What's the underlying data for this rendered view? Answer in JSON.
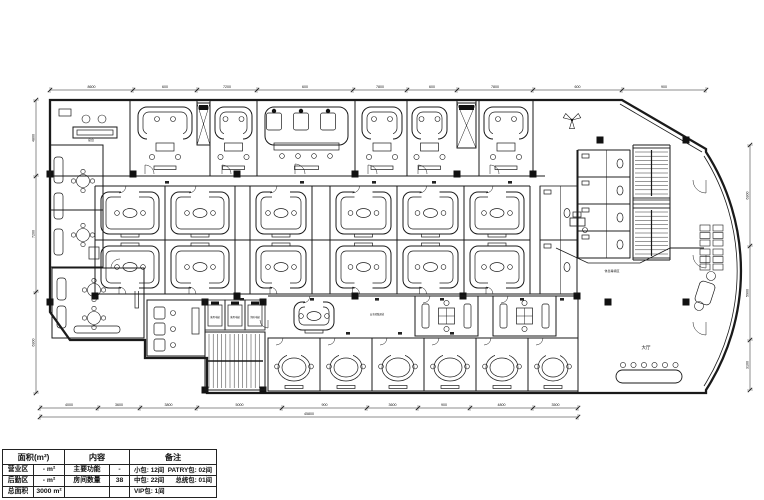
{
  "table": {
    "h1": "面积(m²)",
    "h2": "内容",
    "h3": "备注",
    "rows": [
      {
        "area_label": "营业区",
        "area_value": "- m²",
        "content_label": "主要功能",
        "content_value": "-",
        "remark_left": "小包: 12间",
        "remark_right": "PATRY包: 02间"
      },
      {
        "area_label": "后勤区",
        "area_value": "- m²",
        "content_label": "房间数量",
        "content_value": "38",
        "remark_left": "中包: 22间",
        "remark_right": "总统包: 01间"
      },
      {
        "area_label": "总面积",
        "area_value": "3000 m²",
        "content_label": "",
        "content_value": "",
        "remark_left": "VIP包: 1间",
        "remark_right": ""
      }
    ]
  },
  "plan": {
    "ink": "#1a1a1a",
    "outline": "M50,100 L622,100 L706,149 L706,152 A220 220 0 0 1 706,390 L706,393 L207,393 L207,358 L145,358 L145,340 L70,340 L50,312 Z",
    "extras": [
      "M704,156 A216 216 0 0 1 704,386",
      "M620,104 L702,152",
      "M556,248 L588,263 L640,263 L670,248",
      "M633,200 L670,200 M633,204 L670,204"
    ],
    "walls": [
      [
        50,
        176,
        545,
        176
      ],
      [
        95,
        186,
        530,
        186
      ],
      [
        95,
        240,
        530,
        240
      ],
      [
        95,
        294,
        577,
        294
      ],
      [
        130,
        100,
        130,
        176
      ],
      [
        197,
        100,
        197,
        145
      ],
      [
        210,
        100,
        210,
        176
      ],
      [
        257,
        100,
        257,
        176
      ],
      [
        355,
        100,
        355,
        176
      ],
      [
        407,
        100,
        407,
        176
      ],
      [
        457,
        100,
        457,
        148
      ],
      [
        476,
        100,
        476,
        148
      ],
      [
        479,
        100,
        479,
        176
      ],
      [
        533,
        100,
        533,
        176
      ],
      [
        95,
        186,
        95,
        294
      ],
      [
        165,
        186,
        165,
        294
      ],
      [
        235,
        186,
        235,
        294
      ],
      [
        250,
        186,
        250,
        294
      ],
      [
        312,
        186,
        312,
        294
      ],
      [
        330,
        186,
        330,
        294
      ],
      [
        397,
        186,
        397,
        294
      ],
      [
        464,
        186,
        464,
        294
      ],
      [
        530,
        186,
        530,
        294
      ],
      [
        540,
        186,
        540,
        294
      ],
      [
        577,
        150,
        577,
        294
      ],
      [
        578,
        150,
        630,
        150
      ],
      [
        578,
        258,
        630,
        258
      ],
      [
        630,
        150,
        630,
        258
      ],
      [
        578,
        150,
        578,
        258
      ],
      [
        633,
        145,
        633,
        260
      ],
      [
        670,
        145,
        670,
        260
      ],
      [
        633,
        145,
        670,
        145
      ],
      [
        633,
        260,
        670,
        260
      ],
      [
        670,
        248,
        704,
        248
      ],
      [
        578,
        296,
        578,
        393
      ],
      [
        50,
        145,
        103,
        145
      ],
      [
        103,
        145,
        103,
        267
      ],
      [
        50,
        267,
        103,
        267
      ],
      [
        50,
        210,
        103,
        210
      ],
      [
        268,
        296,
        578,
        296
      ]
    ],
    "columns": [
      [
        133,
        174
      ],
      [
        237,
        174
      ],
      [
        355,
        174
      ],
      [
        457,
        174
      ],
      [
        533,
        174
      ],
      [
        600,
        140
      ],
      [
        686,
        140
      ],
      [
        608,
        302
      ],
      [
        686,
        302
      ],
      [
        95,
        296
      ],
      [
        237,
        296
      ],
      [
        355,
        296
      ],
      [
        463,
        296
      ],
      [
        577,
        296
      ],
      [
        50,
        302
      ],
      [
        50,
        174
      ],
      [
        205,
        302
      ],
      [
        263,
        302
      ],
      [
        205,
        390
      ],
      [
        263,
        390
      ]
    ],
    "rooms": [
      {
        "k": "office",
        "x": 53,
        "y": 103,
        "w": 77,
        "h": 66
      },
      {
        "k": "uroom",
        "x": 133,
        "y": 103,
        "w": 64,
        "h": 70
      },
      {
        "k": "shaft",
        "x": 197,
        "y": 103,
        "w": 13,
        "h": 42
      },
      {
        "k": "uroom",
        "x": 210,
        "y": 103,
        "w": 47,
        "h": 70
      },
      {
        "k": "party",
        "x": 260,
        "y": 103,
        "w": 93,
        "h": 70
      },
      {
        "k": "uroom",
        "x": 357,
        "y": 103,
        "w": 50,
        "h": 70
      },
      {
        "k": "uroom",
        "x": 407,
        "y": 103,
        "w": 45,
        "h": 70
      },
      {
        "k": "shaft",
        "x": 457,
        "y": 103,
        "w": 19,
        "h": 45
      },
      {
        "k": "uroom",
        "x": 479,
        "y": 103,
        "w": 54,
        "h": 70
      },
      {
        "k": "loungeV",
        "x": 50,
        "y": 145,
        "w": 53,
        "h": 122
      },
      {
        "k": "loungeH",
        "x": 52,
        "y": 268,
        "w": 92,
        "h": 70
      },
      {
        "k": "midroom",
        "x": 95,
        "y": 186,
        "w": 70,
        "h": 54,
        "d": "u"
      },
      {
        "k": "midroom",
        "x": 165,
        "y": 186,
        "w": 70,
        "h": 54,
        "d": "u"
      },
      {
        "k": "midroom",
        "x": 95,
        "y": 240,
        "w": 70,
        "h": 54,
        "d": "d"
      },
      {
        "k": "midroom",
        "x": 165,
        "y": 240,
        "w": 70,
        "h": 54,
        "d": "d"
      },
      {
        "k": "midroom",
        "x": 250,
        "y": 186,
        "w": 62,
        "h": 54,
        "d": "u"
      },
      {
        "k": "midroom",
        "x": 250,
        "y": 240,
        "w": 62,
        "h": 54,
        "d": "d"
      },
      {
        "k": "midroom",
        "x": 330,
        "y": 186,
        "w": 67,
        "h": 54,
        "d": "u"
      },
      {
        "k": "midroom",
        "x": 397,
        "y": 186,
        "w": 67,
        "h": 54,
        "d": "u"
      },
      {
        "k": "midroom",
        "x": 464,
        "y": 186,
        "w": 66,
        "h": 54,
        "d": "u"
      },
      {
        "k": "midroom",
        "x": 330,
        "y": 240,
        "w": 67,
        "h": 54,
        "d": "d"
      },
      {
        "k": "midroom",
        "x": 397,
        "y": 240,
        "w": 67,
        "h": 54,
        "d": "d"
      },
      {
        "k": "midroom",
        "x": 464,
        "y": 240,
        "w": 66,
        "h": 54,
        "d": "d"
      },
      {
        "k": "wc",
        "x": 540,
        "y": 186,
        "w": 37,
        "h": 54
      },
      {
        "k": "wc",
        "x": 540,
        "y": 240,
        "w": 37,
        "h": 54
      },
      {
        "k": "threesofa",
        "x": 147,
        "y": 300,
        "w": 58,
        "h": 56
      },
      {
        "k": "elevrow",
        "x": 205,
        "y": 300,
        "w": 60,
        "h": 30
      },
      {
        "k": "stairV",
        "x": 205,
        "y": 332,
        "w": 60,
        "h": 58
      },
      {
        "k": "midroom",
        "x": 288,
        "y": 296,
        "w": 52,
        "h": 40,
        "d": "u"
      },
      {
        "k": "party2",
        "x": 415,
        "y": 296,
        "w": 63,
        "h": 40
      },
      {
        "k": "party2",
        "x": 493,
        "y": 296,
        "w": 63,
        "h": 40
      },
      {
        "k": "smallroom",
        "x": 268,
        "y": 338,
        "w": 52,
        "h": 53
      },
      {
        "k": "smallroom",
        "x": 320,
        "y": 338,
        "w": 52,
        "h": 53
      },
      {
        "k": "smallroom",
        "x": 372,
        "y": 338,
        "w": 52,
        "h": 53
      },
      {
        "k": "smallroom",
        "x": 424,
        "y": 338,
        "w": 52,
        "h": 53
      },
      {
        "k": "smallroom",
        "x": 476,
        "y": 338,
        "w": 52,
        "h": 53
      },
      {
        "k": "smallroom",
        "x": 528,
        "y": 338,
        "w": 50,
        "h": 53
      },
      {
        "k": "wc",
        "x": 578,
        "y": 150,
        "w": 52,
        "h": 27
      },
      {
        "k": "wc",
        "x": 578,
        "y": 177,
        "w": 52,
        "h": 27
      },
      {
        "k": "wc",
        "x": 578,
        "y": 204,
        "w": 52,
        "h": 27
      },
      {
        "k": "wc",
        "x": 578,
        "y": 231,
        "w": 52,
        "h": 27
      },
      {
        "k": "stairH",
        "x": 633,
        "y": 148,
        "w": 37,
        "h": 50
      },
      {
        "k": "stairH",
        "x": 633,
        "y": 208,
        "w": 37,
        "h": 50
      },
      {
        "k": "desk",
        "x": 570,
        "y": 216
      },
      {
        "k": "seats",
        "x": 700,
        "y": 225
      },
      {
        "k": "seats",
        "x": 700,
        "y": 249
      },
      {
        "k": "chaise",
        "x": 697,
        "y": 276
      },
      {
        "k": "ovaltable",
        "x": 616,
        "y": 370
      },
      {
        "k": "fan",
        "x": 572,
        "y": 120
      }
    ],
    "doors": [
      [
        145,
        174,
        9,
        -90
      ],
      [
        222,
        174,
        9,
        -90
      ],
      [
        295,
        174,
        10,
        -90
      ],
      [
        368,
        174,
        9,
        -90
      ],
      [
        418,
        174,
        9,
        -90
      ],
      [
        490,
        174,
        9,
        -90
      ],
      [
        706,
        180,
        13,
        90
      ],
      [
        706,
        255,
        13,
        90
      ],
      [
        706,
        322,
        13,
        90
      ],
      [
        120,
        268,
        9,
        180
      ],
      [
        268,
        320,
        8,
        90
      ]
    ],
    "dots": [
      [
        300,
        181
      ],
      [
        372,
        181
      ],
      [
        432,
        181
      ],
      [
        508,
        181
      ],
      [
        165,
        181
      ],
      [
        240,
        298
      ],
      [
        310,
        298
      ],
      [
        375,
        298
      ],
      [
        440,
        298
      ],
      [
        520,
        298
      ],
      [
        560,
        298
      ],
      [
        346,
        332
      ],
      [
        398,
        332
      ],
      [
        450,
        332
      ]
    ],
    "dims": {
      "top": {
        "y": 90,
        "ticks": [
          50,
          133,
          197,
          257,
          353,
          407,
          457,
          533,
          622,
          706
        ],
        "labels": [
          "8600",
          "600",
          "7200",
          "600",
          "7800",
          "600",
          "7800",
          "600",
          "900"
        ]
      },
      "bottom1": {
        "y": 408,
        "ticks": [
          40,
          98,
          140,
          197,
          282,
          367,
          418,
          470,
          533,
          578
        ],
        "labels": [
          "4000",
          "3600",
          "3800",
          "5000",
          "900",
          "3600",
          "900",
          "4800",
          "3500"
        ]
      },
      "bottom2": {
        "y": 417,
        "ticks": [
          40,
          578
        ],
        "labels": [
          "45800"
        ]
      },
      "left": {
        "x": 36,
        "ticks": [
          100,
          176,
          292,
          393
        ],
        "labels": [
          "4800",
          "7200",
          "6300"
        ]
      },
      "right": {
        "x": 750,
        "ticks": [
          145,
          246,
          340,
          390
        ],
        "labels": [
          "6300",
          "5900",
          "3100"
        ]
      }
    },
    "labels": [
      {
        "x": 91,
        "y": 141,
        "t": "总台",
        "s": 3
      },
      {
        "x": 215,
        "y": 318,
        "t": "客用电梯",
        "s": 2.4
      },
      {
        "x": 235,
        "y": 318,
        "t": "客用电梯",
        "s": 2.4
      },
      {
        "x": 255,
        "y": 318,
        "t": "消防电梯",
        "s": 2.4
      },
      {
        "x": 612,
        "y": 272,
        "t": "休息等候区",
        "s": 3
      },
      {
        "x": 377,
        "y": 315,
        "t": "安全疏散通道",
        "s": 2.4
      },
      {
        "x": 646,
        "y": 349,
        "t": "大厅",
        "s": 4.5
      }
    ]
  }
}
